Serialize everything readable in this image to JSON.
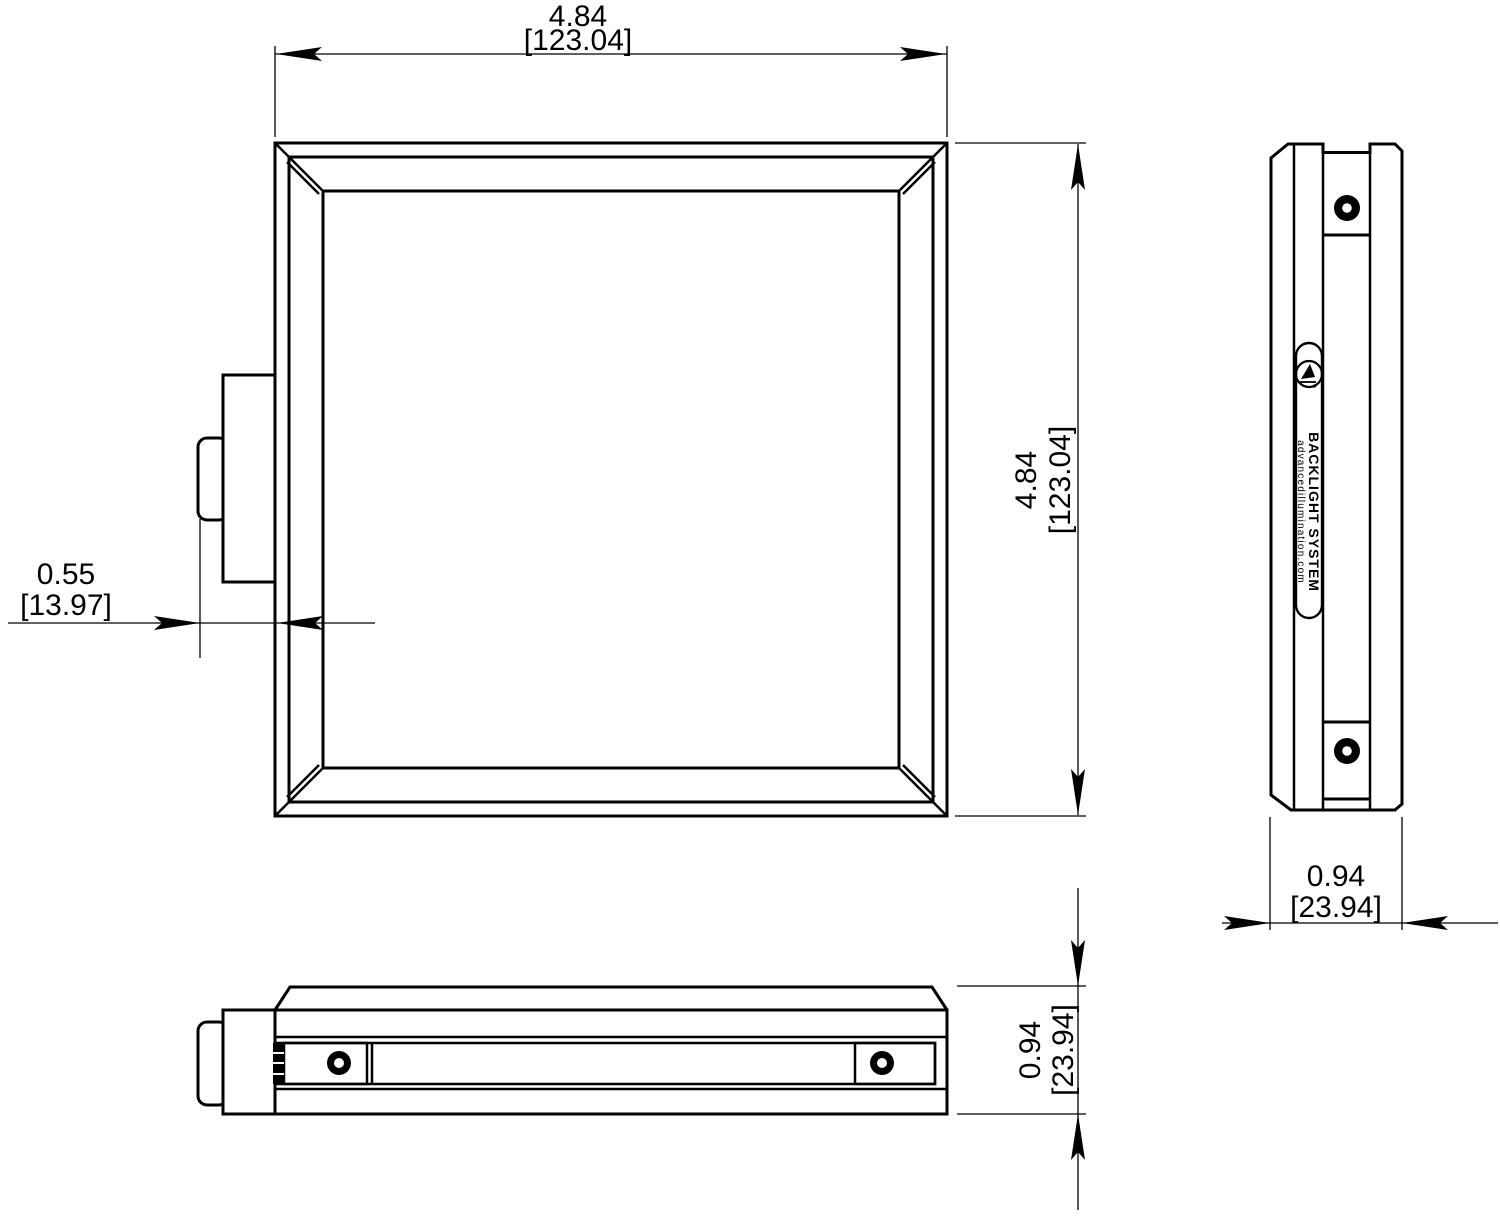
{
  "dimensions": {
    "width": {
      "inches": "4.84",
      "mm": "[123.04]"
    },
    "height": {
      "inches": "4.84",
      "mm": "[123.04]"
    },
    "connector_offset": {
      "inches": "0.55",
      "mm": "[13.97]"
    },
    "side_thickness": {
      "inches": "0.94",
      "mm": "[23.94]"
    },
    "bottom_thickness": {
      "inches": "0.94",
      "mm": "[23.94]"
    }
  },
  "label": {
    "product": "BACKLIGHT SYSTEM",
    "website": "advancedillumination.com"
  },
  "colors": {
    "line": "#000000",
    "background": "#ffffff"
  }
}
